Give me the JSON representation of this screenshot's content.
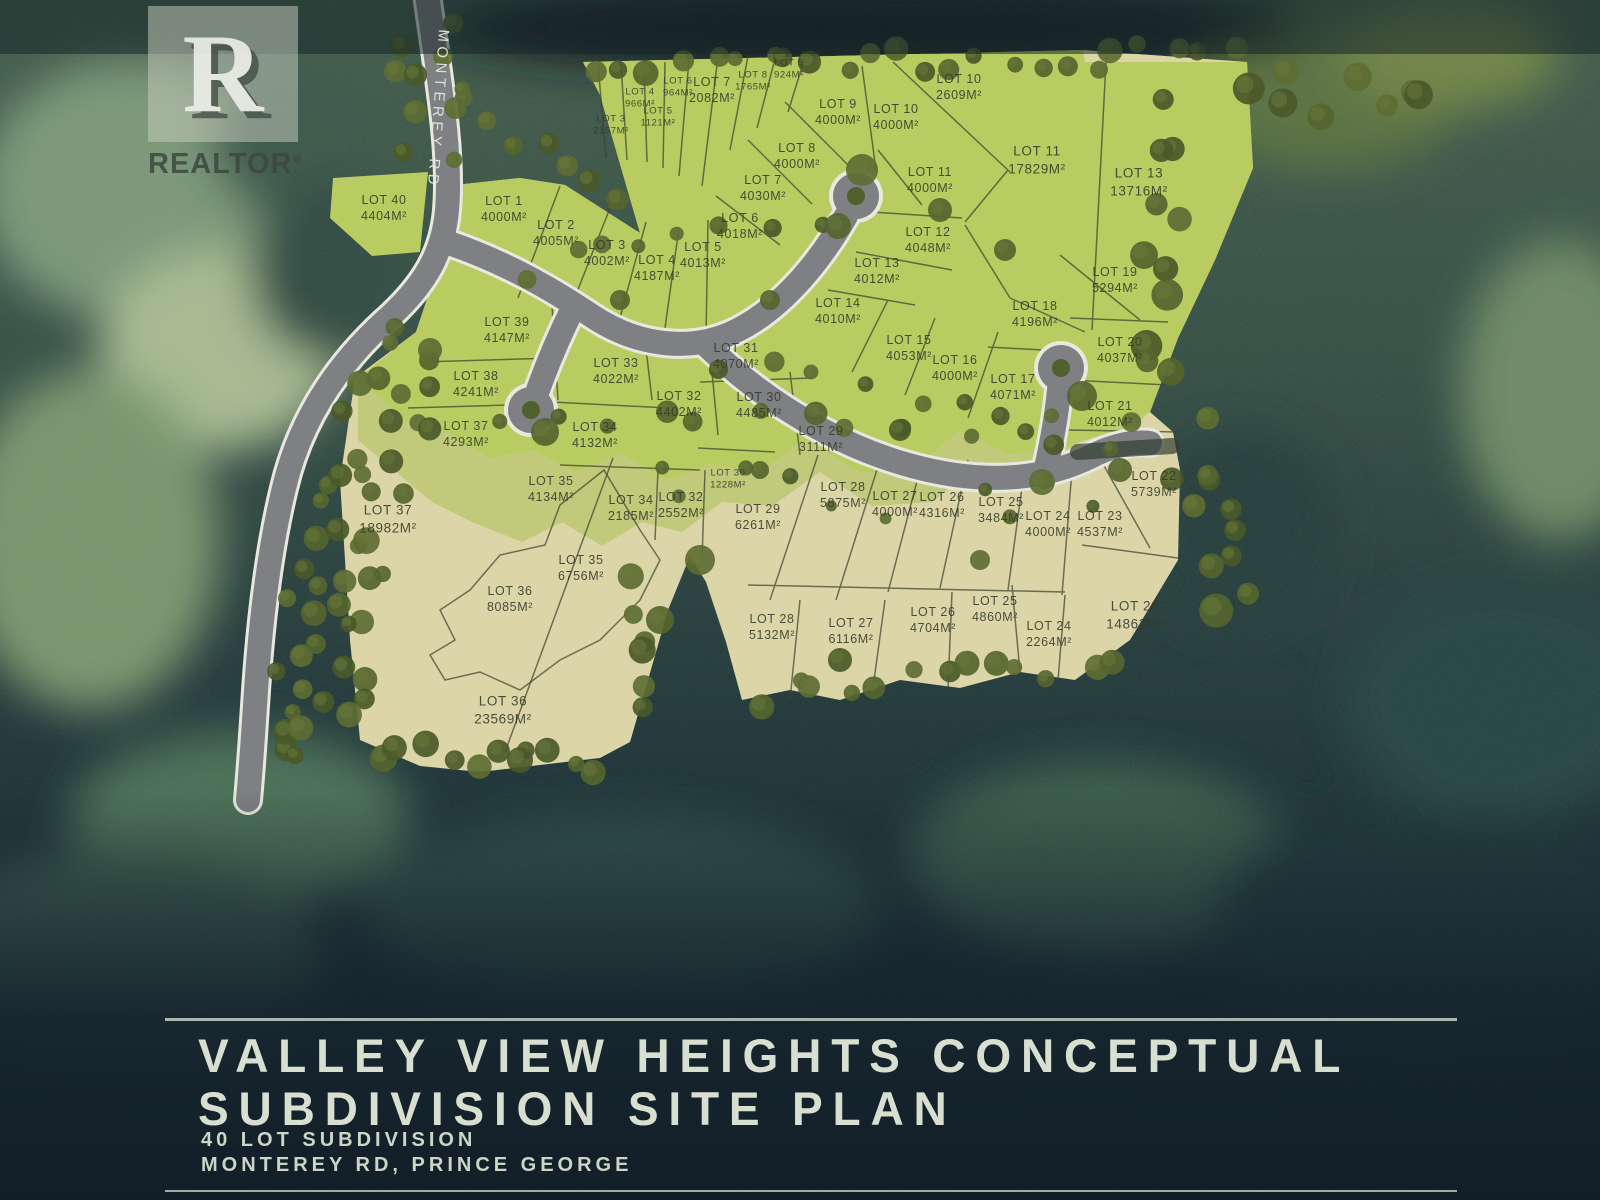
{
  "branding": {
    "logo_letter": "R",
    "logo_text": "REALTOR",
    "registered": "®"
  },
  "map": {
    "road_label": "MONTEREY RD"
  },
  "title_block": {
    "line1": "VALLEY VIEW HEIGHTS CONCEPTUAL",
    "line2": "SUBDIVISION SITE PLAN",
    "sub1": "40 LOT SUBDIVISION",
    "sub2": "MONTEREY RD, PRINCE GEORGE"
  },
  "colors": {
    "lot_green": "#b8cc61",
    "lot_olive": "#c1c97a",
    "lot_beige": "#dcd5a8",
    "road_gray": "#7e8083",
    "forest_dark": "#1d2e31",
    "title_text": "#d8dfd1",
    "label_text": "#343b2b"
  },
  "lots": [
    {
      "n": "LOT 3",
      "a": "2157M²",
      "x": 611,
      "y": 126,
      "s": "sm"
    },
    {
      "n": "LOT 4",
      "a": "966M²",
      "x": 640,
      "y": 99,
      "s": "sm"
    },
    {
      "n": "LOT 5",
      "a": "1121M²",
      "x": 658,
      "y": 118,
      "s": "sm"
    },
    {
      "n": "LOT 6",
      "a": "964M²",
      "x": 678,
      "y": 88,
      "s": "sm"
    },
    {
      "n": "LOT 7",
      "a": "2082M²",
      "x": 712,
      "y": 90,
      "s": "md"
    },
    {
      "n": "LOT 8",
      "a": "1765M²",
      "x": 753,
      "y": 82,
      "s": "sm"
    },
    {
      "n": "LOT 9",
      "a": "924M²",
      "x": 789,
      "y": 70,
      "s": "sm"
    },
    {
      "n": "LOT 10",
      "a": "2609M²",
      "x": 959,
      "y": 87,
      "s": "md"
    },
    {
      "n": "LOT 40",
      "a": "4404M²",
      "x": 384,
      "y": 208,
      "s": "md"
    },
    {
      "n": "LOT 1",
      "a": "4000M²",
      "x": 504,
      "y": 209,
      "s": "md"
    },
    {
      "n": "LOT 2",
      "a": "4005M²",
      "x": 556,
      "y": 233,
      "s": "md"
    },
    {
      "n": "LOT 3",
      "a": "4002M²",
      "x": 607,
      "y": 253,
      "s": "md"
    },
    {
      "n": "LOT 4",
      "a": "4187M²",
      "x": 657,
      "y": 268,
      "s": "md"
    },
    {
      "n": "LOT 5",
      "a": "4013M²",
      "x": 703,
      "y": 255,
      "s": "md"
    },
    {
      "n": "LOT 6",
      "a": "4018M²",
      "x": 740,
      "y": 226,
      "s": "md"
    },
    {
      "n": "LOT 7",
      "a": "4030M²",
      "x": 763,
      "y": 188,
      "s": "md"
    },
    {
      "n": "LOT 8",
      "a": "4000M²",
      "x": 797,
      "y": 156,
      "s": "md"
    },
    {
      "n": "LOT 9",
      "a": "4000M²",
      "x": 838,
      "y": 112,
      "s": "md"
    },
    {
      "n": "LOT 10",
      "a": "4000M²",
      "x": 896,
      "y": 117,
      "s": "md"
    },
    {
      "n": "LOT 11",
      "a": "4000M²",
      "x": 930,
      "y": 180,
      "s": "md"
    },
    {
      "n": "LOT 11",
      "a": "17829M²",
      "x": 1037,
      "y": 160,
      "s": "lg"
    },
    {
      "n": "LOT 12",
      "a": "4048M²",
      "x": 928,
      "y": 240,
      "s": "md"
    },
    {
      "n": "LOT 13",
      "a": "13716M²",
      "x": 1139,
      "y": 182,
      "s": "lg"
    },
    {
      "n": "LOT 13",
      "a": "4012M²",
      "x": 877,
      "y": 271,
      "s": "md"
    },
    {
      "n": "LOT 14",
      "a": "4010M²",
      "x": 838,
      "y": 311,
      "s": "md"
    },
    {
      "n": "LOT 15",
      "a": "4053M²",
      "x": 909,
      "y": 348,
      "s": "md"
    },
    {
      "n": "LOT 16",
      "a": "4000M²",
      "x": 955,
      "y": 368,
      "s": "md"
    },
    {
      "n": "LOT 17",
      "a": "4071M²",
      "x": 1013,
      "y": 387,
      "s": "md"
    },
    {
      "n": "LOT 18",
      "a": "4196M²",
      "x": 1035,
      "y": 314,
      "s": "md"
    },
    {
      "n": "LOT 19",
      "a": "5294M²",
      "x": 1115,
      "y": 280,
      "s": "md"
    },
    {
      "n": "LOT 20",
      "a": "4037M²",
      "x": 1120,
      "y": 350,
      "s": "md"
    },
    {
      "n": "LOT 21",
      "a": "4012M²",
      "x": 1110,
      "y": 414,
      "s": "md"
    },
    {
      "n": "LOT 22",
      "a": "5739M²",
      "x": 1154,
      "y": 484,
      "s": "md"
    },
    {
      "n": "LOT 39",
      "a": "4147M²",
      "x": 507,
      "y": 330,
      "s": "md"
    },
    {
      "n": "LOT 38",
      "a": "4241M²",
      "x": 476,
      "y": 384,
      "s": "md"
    },
    {
      "n": "LOT 37",
      "a": "4293M²",
      "x": 466,
      "y": 434,
      "s": "md"
    },
    {
      "n": "LOT 33",
      "a": "4022M²",
      "x": 616,
      "y": 371,
      "s": "md"
    },
    {
      "n": "LOT 32",
      "a": "4402M²",
      "x": 679,
      "y": 404,
      "s": "md"
    },
    {
      "n": "LOT 34",
      "a": "4132M²",
      "x": 595,
      "y": 435,
      "s": "md"
    },
    {
      "n": "LOT 31",
      "a": "4070M²",
      "x": 736,
      "y": 356,
      "s": "md"
    },
    {
      "n": "LOT 30",
      "a": "4485M²",
      "x": 759,
      "y": 405,
      "s": "md"
    },
    {
      "n": "LOT 29",
      "a": "3111M²",
      "x": 821,
      "y": 439,
      "s": "md"
    },
    {
      "n": "LOT 30",
      "a": "1228M²",
      "x": 728,
      "y": 480,
      "s": "sm"
    },
    {
      "n": "LOT 35",
      "a": "4134M²",
      "x": 551,
      "y": 489,
      "s": "md"
    },
    {
      "n": "LOT 34",
      "a": "2185M²",
      "x": 631,
      "y": 508,
      "s": "md"
    },
    {
      "n": "LOT 32",
      "a": "2552M²",
      "x": 681,
      "y": 505,
      "s": "md"
    },
    {
      "n": "LOT 37",
      "a": "18982M²",
      "x": 388,
      "y": 519,
      "s": "lg"
    },
    {
      "n": "LOT 35",
      "a": "6756M²",
      "x": 581,
      "y": 568,
      "s": "md"
    },
    {
      "n": "LOT 36",
      "a": "8085M²",
      "x": 510,
      "y": 599,
      "s": "md"
    },
    {
      "n": "LOT 36",
      "a": "23569M²",
      "x": 503,
      "y": 710,
      "s": "lg"
    },
    {
      "n": "LOT 29",
      "a": "6261M²",
      "x": 758,
      "y": 517,
      "s": "md"
    },
    {
      "n": "LOT 28",
      "a": "5875M²",
      "x": 843,
      "y": 495,
      "s": "md"
    },
    {
      "n": "LOT 27",
      "a": "4000M²",
      "x": 895,
      "y": 504,
      "s": "md"
    },
    {
      "n": "LOT 26",
      "a": "4316M²",
      "x": 942,
      "y": 505,
      "s": "md"
    },
    {
      "n": "LOT 25",
      "a": "3484M²",
      "x": 1001,
      "y": 510,
      "s": "md"
    },
    {
      "n": "LOT 24",
      "a": "4000M²",
      "x": 1048,
      "y": 524,
      "s": "md"
    },
    {
      "n": "LOT 23",
      "a": "4537M²",
      "x": 1100,
      "y": 524,
      "s": "md"
    },
    {
      "n": "LOT 28",
      "a": "5132M²",
      "x": 772,
      "y": 627,
      "s": "md"
    },
    {
      "n": "LOT 27",
      "a": "6116M²",
      "x": 851,
      "y": 631,
      "s": "md"
    },
    {
      "n": "LOT 26",
      "a": "4704M²",
      "x": 933,
      "y": 620,
      "s": "md"
    },
    {
      "n": "LOT 25",
      "a": "4860M²",
      "x": 995,
      "y": 609,
      "s": "md"
    },
    {
      "n": "LOT 24",
      "a": "2264M²",
      "x": 1049,
      "y": 634,
      "s": "md"
    },
    {
      "n": "LOT 26",
      "a": "14863M²",
      "x": 1135,
      "y": 615,
      "s": "lg"
    }
  ]
}
